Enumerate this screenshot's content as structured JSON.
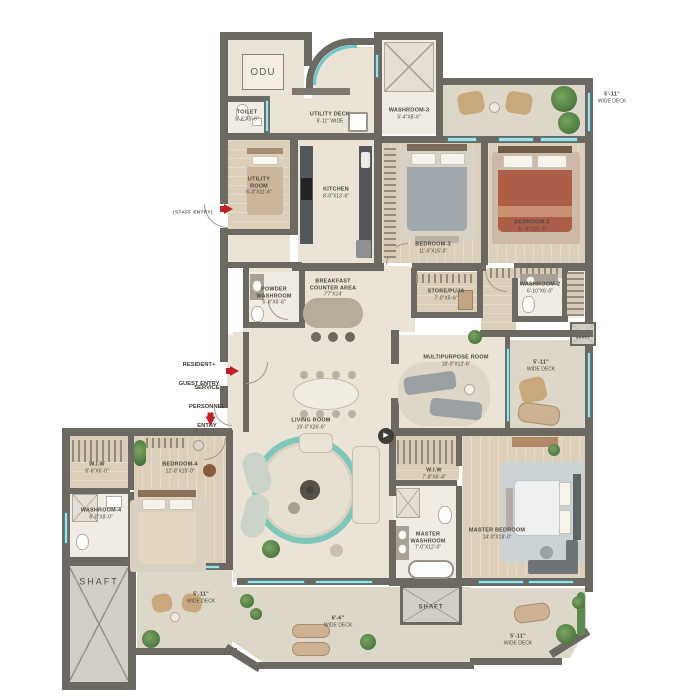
{
  "plan_title": "apartment-floor-plan",
  "colors": {
    "wall": "#6c6963",
    "floor": "#ebe3d5",
    "deck": "#ddd7c9",
    "wood": "#dccfb9",
    "window": "#a6dee2",
    "accent_red": "#bf2328",
    "rug_teal": "#7fc6bb",
    "plant_green": "#4e7a41",
    "bed2_blanket": "#ad5e49",
    "bed3_blanket": "#9fa9ad"
  },
  "labels": {
    "odu": {
      "name": "ODU"
    },
    "staff_entry": {
      "name": "(STAFF ENTRY)"
    },
    "toilet": {
      "name": "TOILET",
      "dims": "5'-6\"X5'-6\""
    },
    "utility_room": {
      "name": "UTILITY\nROOM",
      "dims": "6'-0\"X11'-6\""
    },
    "utility_deck": {
      "name": "UTILITY DECK",
      "dims": "5'-11\" WIDE"
    },
    "washroom3": {
      "name": "WASHROOM-3",
      "dims": "5'-4\"X8'-6\""
    },
    "kitchen": {
      "name": "KITCHEN",
      "dims": "8'-0\"X13'-6\""
    },
    "bedroom3": {
      "name": "BEDROOM-3",
      "dims": "11'-6\"X15'-0\""
    },
    "bedroom2": {
      "name": "BEDROOM-2",
      "dims": "11'-6\"X15'-0\""
    },
    "deck_top_right": {
      "name": "5'-11\"",
      "dims": "WIDE DECK"
    },
    "powder_washroom": {
      "name": "POWDER\nWASHROOM",
      "dims": "5'-0\"X6'-6\""
    },
    "breakfast": {
      "name": "BREAKFAST\nCOUNTER AREA",
      "dims": "7'7\"X14'"
    },
    "store_puja": {
      "name": "STORE/PUJA",
      "dims": "7'-0\"X5'-6\""
    },
    "washroom2": {
      "name": "WASHROOM-2",
      "dims": "6'-10\"X6'-0\""
    },
    "shaft_right": {
      "name": "SHAFT"
    },
    "multipurpose": {
      "name": "MULTIPURPOSE ROOM",
      "dims": "18'-0\"X12'-6\""
    },
    "deck_right": {
      "name": "5'-11\"",
      "dims": "WIDE DECK"
    },
    "resident_entry": {
      "name": "RESIDENT+\nGUEST ENTRY"
    },
    "service_entry": {
      "name": "SERVICE\nPERSONNEL\nENTRY"
    },
    "living_room": {
      "name": "LIVING ROOM",
      "dims": "19'-0\"X26'-6\""
    },
    "wiw4": {
      "name": "W.I.W",
      "dims": "6'-6\"X6'-0\""
    },
    "bedroom4": {
      "name": "BEDROOM-4",
      "dims": "12'-0\"X15'-0\""
    },
    "washroom4": {
      "name": "WASHROOM-4",
      "dims": "6'-0\"X8'-0\""
    },
    "shaft_bottom_left": {
      "name": "SHAFT"
    },
    "deck_bottom_left": {
      "name": "5'-11\"",
      "dims": "WIDE DECK"
    },
    "deck_bottom_mid": {
      "name": "6'-6\"",
      "dims": "WIDE DECK"
    },
    "shaft_bottom_mid": {
      "name": "SHAFT"
    },
    "deck_bottom_right": {
      "name": "5'-11\"",
      "dims": "WIDE DECK"
    },
    "wiw_master": {
      "name": "W.I.W",
      "dims": "7'-8\"X6'-4\""
    },
    "master_washroom": {
      "name": "MASTER\nWASHROOM",
      "dims": "7'-0\"X12'-0\""
    },
    "master_bedroom": {
      "name": "MASTER BEDROOM",
      "dims": "14'-0\"X18'-0\""
    }
  }
}
